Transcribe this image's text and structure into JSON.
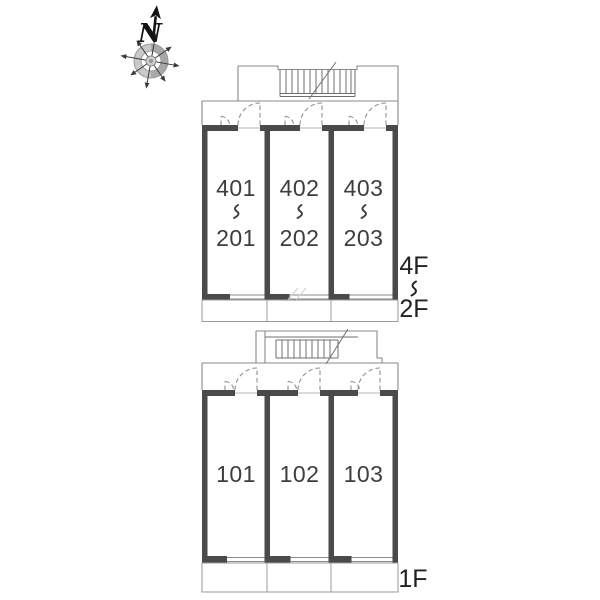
{
  "compass": {
    "north_label": "N"
  },
  "buildings": {
    "upper": {
      "floors_shown": "4F-2F stacked plan",
      "rooms": [
        {
          "top": "401",
          "separator": "〜",
          "bottom": "201"
        },
        {
          "top": "402",
          "separator": "〜",
          "bottom": "202"
        },
        {
          "top": "403",
          "separator": "〜",
          "bottom": "203"
        }
      ],
      "floor_range": {
        "top": "4F",
        "separator": "〜",
        "bottom": "2F"
      }
    },
    "lower": {
      "floors_shown": "1F plan",
      "rooms": [
        {
          "number": "101"
        },
        {
          "number": "102"
        },
        {
          "number": "103"
        }
      ],
      "floor_label": "1F"
    }
  },
  "colors": {
    "wall": "#4a4a4a",
    "thin_line": "#8a8a8a",
    "room_text": "#3d3d3d",
    "label_text": "#222222",
    "compass_ring": "#c2c2c2"
  }
}
